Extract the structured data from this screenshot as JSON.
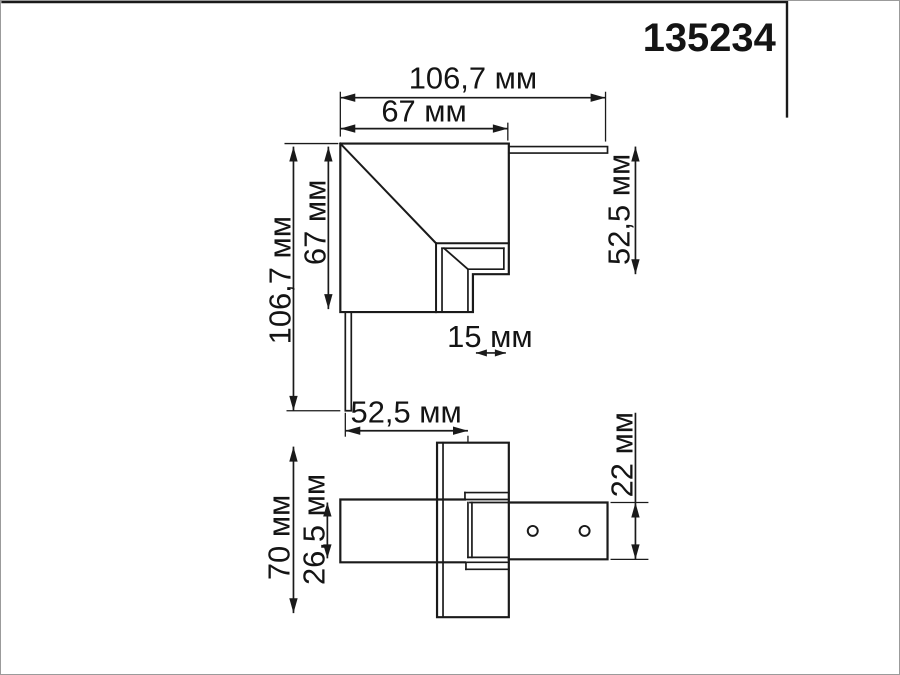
{
  "part_number": "135234",
  "unit": "мм",
  "views": {
    "top": {
      "title": "top-view-corner-connector",
      "dims": {
        "total_width": "106,7 мм",
        "body_width": "67 мм",
        "total_height": "106,7 мм",
        "body_height": "67 мм",
        "side_height": "52,5 мм",
        "slot_width": "15 мм"
      }
    },
    "side": {
      "title": "side-view-corner-connector",
      "dims": {
        "arm_length": "52,5 мм",
        "total_height": "70 мм",
        "track_height": "26,5 мм",
        "connector_height": "22 мм"
      }
    }
  },
  "colors": {
    "line": "#1a1a1a",
    "background": "#ffffff"
  }
}
